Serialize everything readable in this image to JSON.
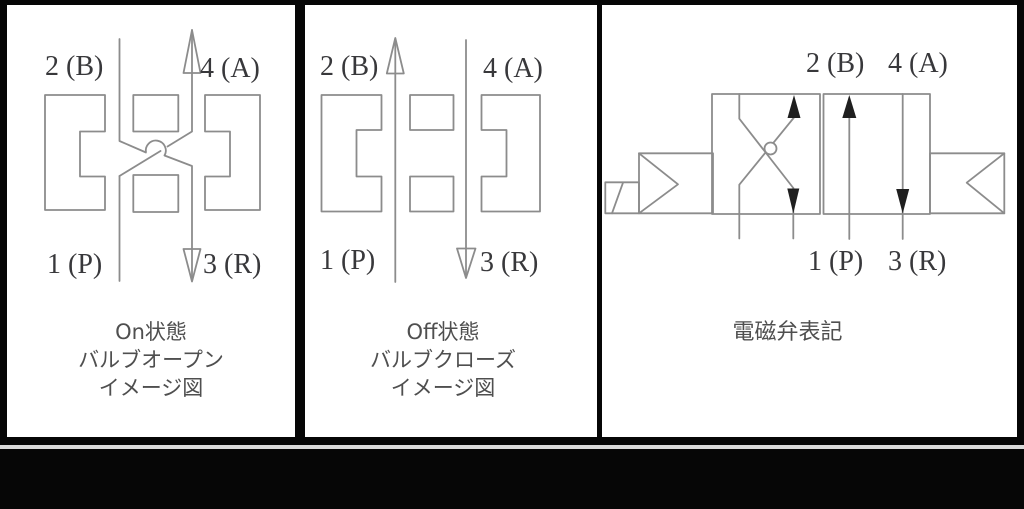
{
  "colors": {
    "line": "#8c8c8c",
    "port_label": "#38383b",
    "caption": "#4f4f4f",
    "panel_bg": "#ffffff",
    "frame": "#060606",
    "filled_arrow": "#1f1f1f"
  },
  "panels": [
    {
      "id": "on-state",
      "ports": {
        "top_left": "2 (B)",
        "top_right": "4 (A)",
        "bottom_left": "1 (P)",
        "bottom_right": "3 (R)"
      },
      "caption_lines": [
        "On状態",
        "バルブオープン",
        "イメージ図"
      ]
    },
    {
      "id": "off-state",
      "ports": {
        "top_left": "2 (B)",
        "top_right": "4 (A)",
        "bottom_left": "1 (P)",
        "bottom_right": "3 (R)"
      },
      "caption_lines": [
        "Off状態",
        "バルブクローズ",
        "イメージ図"
      ]
    },
    {
      "id": "solenoid-symbol",
      "ports": {
        "top_left": "2 (B)",
        "top_right": "4 (A)",
        "bottom_left": "1 (P)",
        "bottom_right": "3 (R)"
      },
      "caption_lines": [
        "電磁弁表記"
      ]
    }
  ]
}
